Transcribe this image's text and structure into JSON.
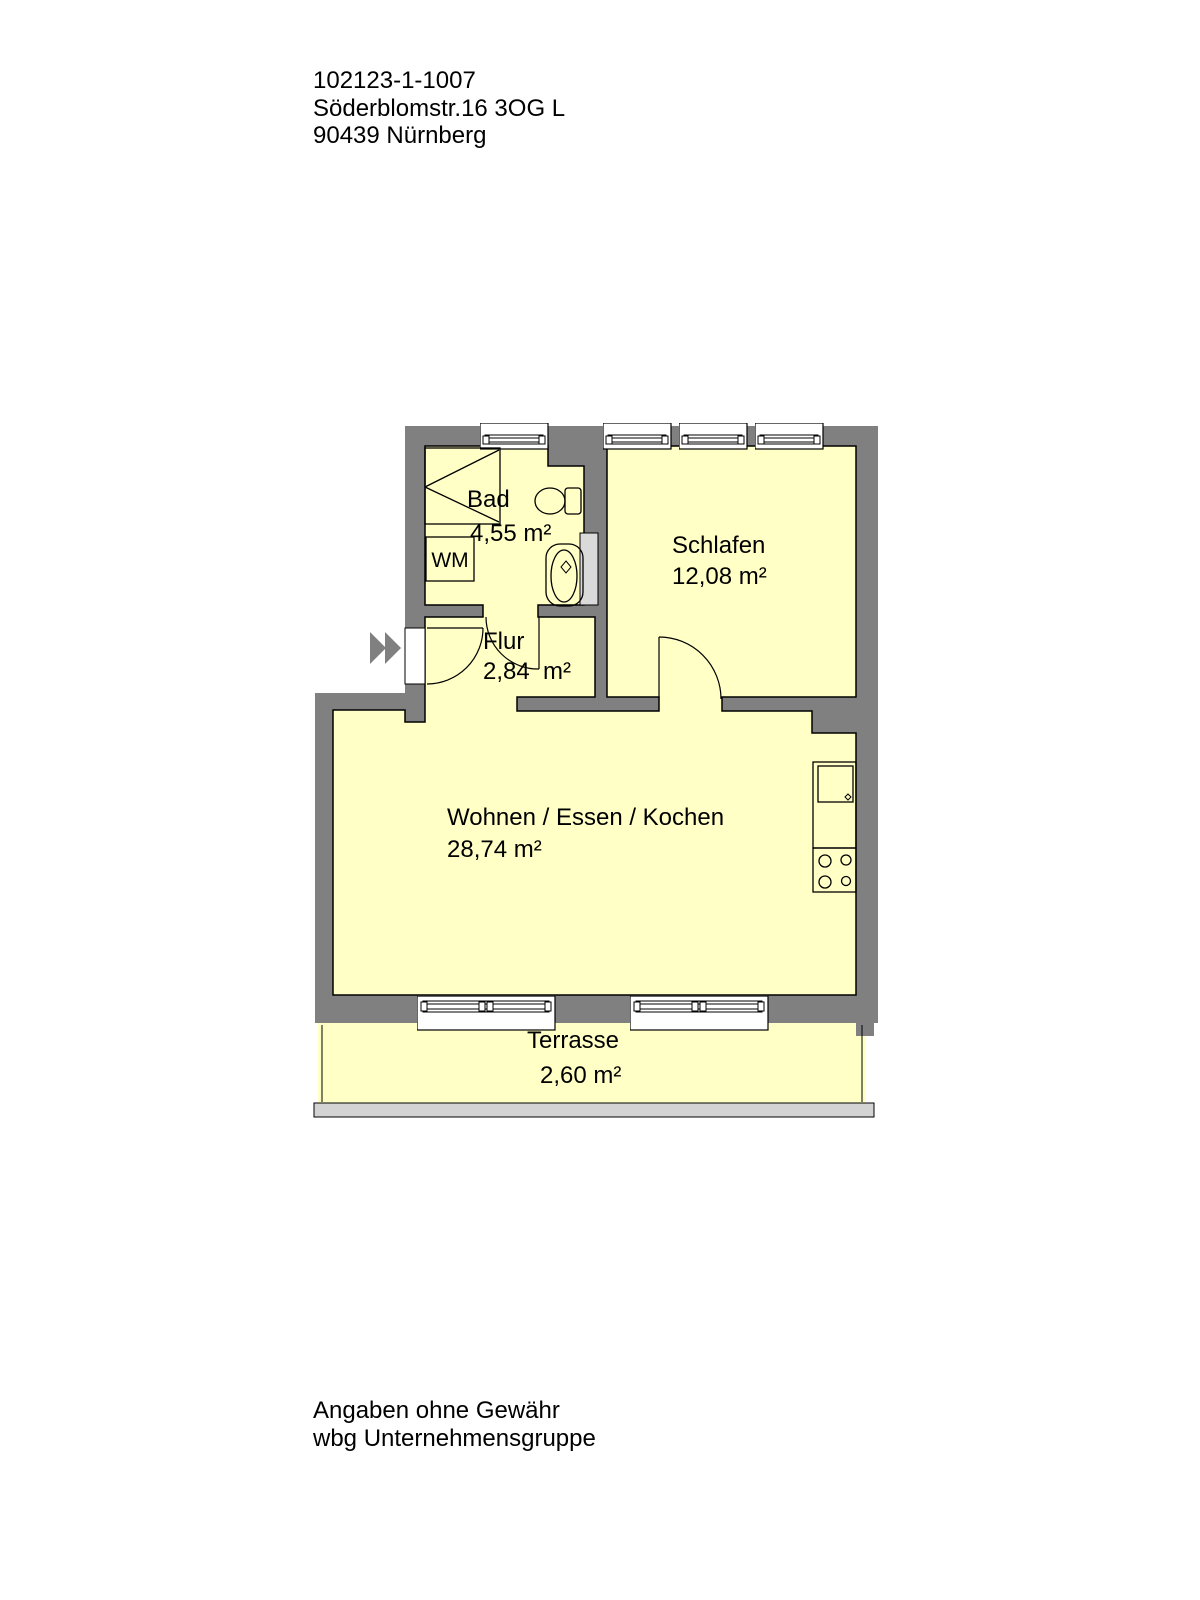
{
  "header": {
    "line1": "102123-1-1007",
    "line2": "Söderblomstr.16 3OG L",
    "line3": "90439 Nürnberg"
  },
  "rooms": {
    "bad": {
      "name": "Bad",
      "area": "4,55 m²"
    },
    "schlafen": {
      "name": "Schlafen",
      "area": "12,08 m²"
    },
    "flur": {
      "name": "Flur",
      "area": "2,84  m²"
    },
    "wohnen": {
      "name": "Wohnen / Essen / Kochen",
      "area": "28,74 m²"
    },
    "terrasse": {
      "name": "Terrasse",
      "area": "2,60 m²"
    }
  },
  "labels": {
    "washing_machine": "WM"
  },
  "footer": {
    "line1": "Angaben ohne Gewähr",
    "line2": "wbg Unternehmensgruppe"
  },
  "colors": {
    "wall": "#808080",
    "room_fill": "#FFFFC6",
    "shaft_fill": "#DADADA",
    "terrace_base": "#D3D3D3",
    "line": "#000000",
    "arrow": "#808080",
    "background": "#FFFFFF"
  }
}
